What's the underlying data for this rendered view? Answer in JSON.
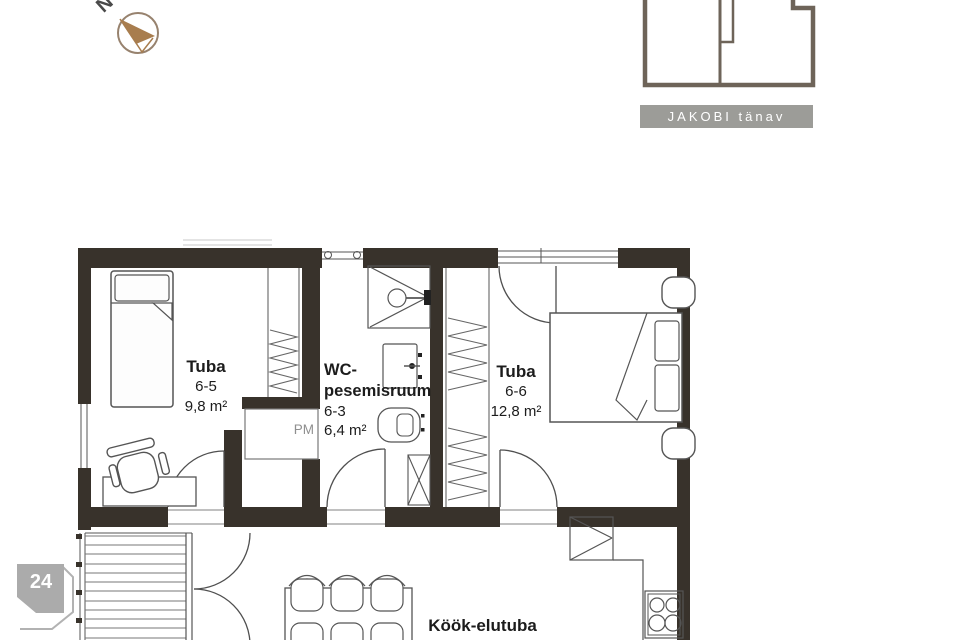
{
  "compass": {
    "north_label": "N"
  },
  "site_plan": {
    "street_label": "JAKOBI tänav"
  },
  "page_badge": {
    "number": "24"
  },
  "rooms": {
    "tuba_65": {
      "name": "Tuba",
      "number": "6-5",
      "area": "9,8 m²"
    },
    "wc": {
      "name_line1": "WC-",
      "name_line2": "pesemisruum",
      "number": "6-3",
      "area": "6,4 m²"
    },
    "tuba_66": {
      "name": "Tuba",
      "number": "6-6",
      "area": "12,8 m²"
    },
    "kook_elutuba": {
      "name": "Köök-elutuba"
    }
  },
  "appliances": {
    "washing_machine": "PM"
  },
  "colors": {
    "wall": "#38322b",
    "site_outline": "#6e6459",
    "street_bar_bg": "#9c9c98",
    "street_bar_text": "#ffffff",
    "compass_needle": "#a87d4e",
    "badge_bg": "#ababab",
    "badge_text": "#ffffff"
  }
}
